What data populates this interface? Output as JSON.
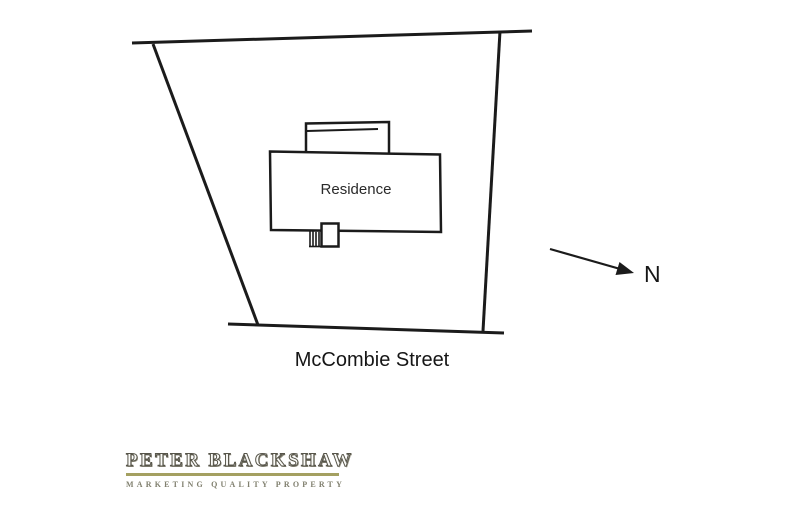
{
  "site_plan": {
    "residence_label": "Residence",
    "street_label": "McCombie Street",
    "north_label": "N",
    "north_arrow_icon": "north-arrow-icon"
  },
  "branding": {
    "agency_name": "PETER BLACKSHAW",
    "tagline": "MARKETING QUALITY PROPERTY"
  },
  "colors": {
    "background": "#ffffff",
    "line": "#1b1b1b",
    "logo_text": "#57554a",
    "logo_rule": "#a4a061",
    "tagline_text": "#81806f"
  }
}
